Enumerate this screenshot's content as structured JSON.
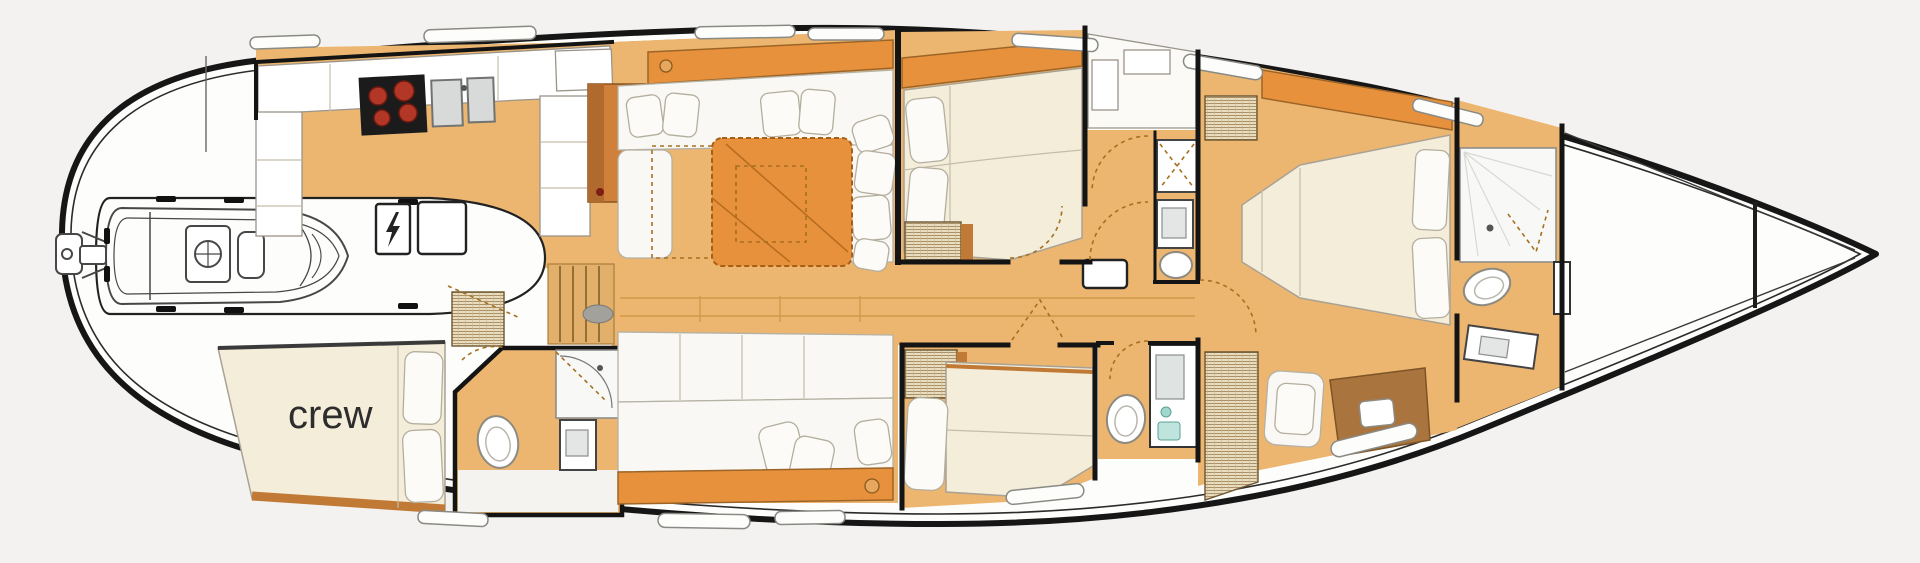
{
  "labels": {
    "crew_cabin": "crew"
  },
  "colors": {
    "page_bg": "#f3f2f0",
    "hull_fill": "#fdfdfb",
    "hull_stroke": "#161616",
    "wall": "#141414",
    "floor": "#ecb671",
    "accent_orange": "#e8913c",
    "wood": "#c07a35",
    "wood_dark": "#9c6527",
    "bed_cream": "#f3edda",
    "white_soft": "#f9f8f4",
    "pillow": "#fcfbf7",
    "outline_soft": "#a9a294",
    "cooktop": "#1b1b1b",
    "burner": "#b23726",
    "steel": "#d7dad8",
    "dash": "#a5701f",
    "label": "#2d2d2d",
    "window_stroke": "#8a8a85",
    "gray_oval": "#a3a19c",
    "tender_line": "#474747"
  }
}
